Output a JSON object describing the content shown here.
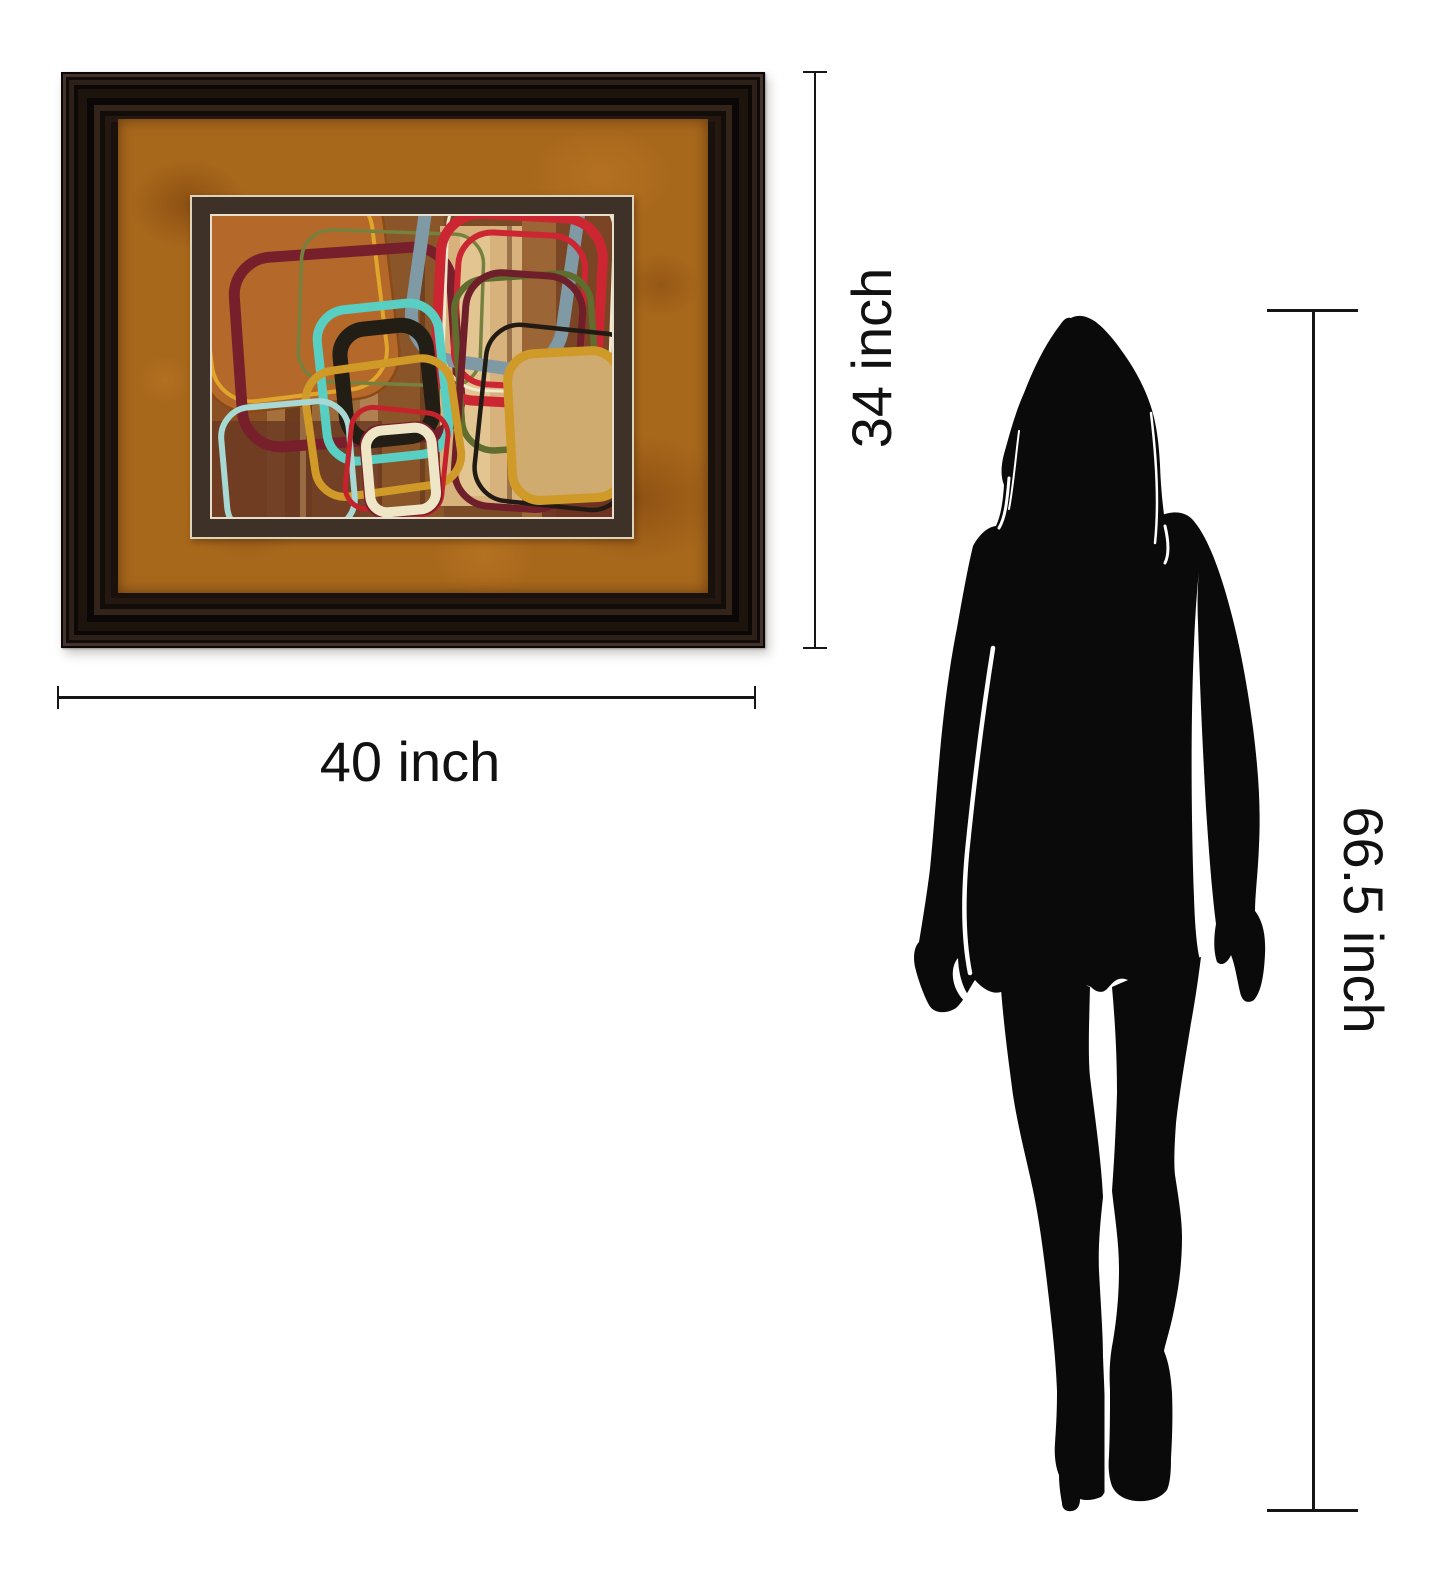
{
  "diagram": {
    "type": "product-size-comparison",
    "artwork_height_label": "34 inch",
    "artwork_width_label": "40 inch",
    "person_height_label": "66.5 inch"
  },
  "artwork": {
    "frame_color": "#1a110c",
    "mat_color": "#a8681c",
    "inner_mat_color": "#3e3127",
    "pinstripe_color": "#e7decb",
    "style": "abstract retro rounded rectangles on wood-grain brown",
    "palette": [
      "#b4692a",
      "#77202c",
      "#59cfc4",
      "#221d15",
      "#d09a28",
      "#a8d8d4",
      "#c5232b",
      "#efe6c8",
      "#cc2633",
      "#7f9aa5",
      "#f0e8cf",
      "#5f6d2e",
      "#d9b87f"
    ]
  },
  "figure": {
    "description": "standing woman silhouette",
    "color": "#0a0a0a"
  },
  "annotation": {
    "line_color": "#161616",
    "text_color": "#111111"
  }
}
